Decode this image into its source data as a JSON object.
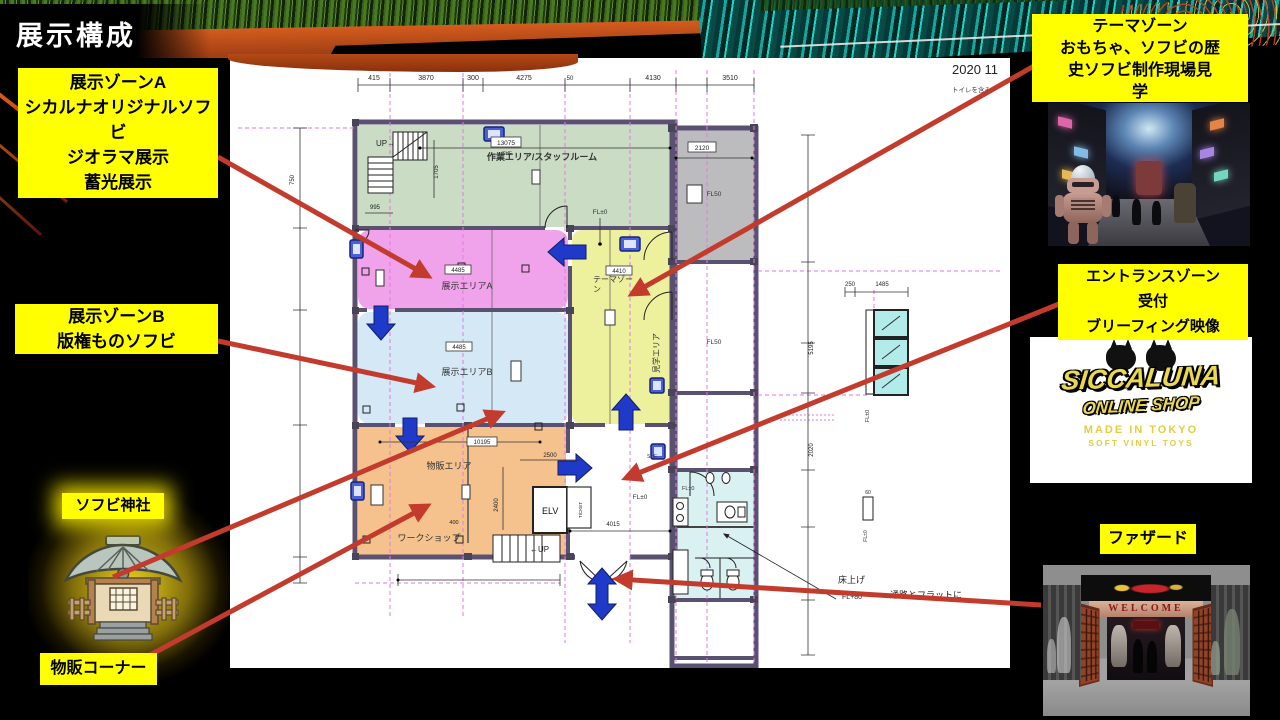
{
  "slide": {
    "title": "展示構成"
  },
  "callouts": {
    "zone_a": {
      "lines": [
        "展示ゾーンA",
        "シカルナオリジナルソフ",
        "ビ",
        "ジオラマ展示",
        "蓄光展示"
      ]
    },
    "zone_b": {
      "lines": [
        "展示ゾーンB",
        "版権ものソフビ"
      ]
    },
    "shrine": {
      "label": "ソフビ神社"
    },
    "sales": {
      "label": "物販コーナー"
    },
    "theme": {
      "lines": [
        "テーマゾーン",
        "おもちゃ、ソフビの歴",
        "史ソフビ制作現場見",
        "学"
      ]
    },
    "entrance": {
      "lines": [
        "エントランスゾーン",
        "受付",
        "ブリーフィング映像"
      ]
    },
    "facade": {
      "label": "ファザード"
    }
  },
  "plan": {
    "date": "2020 11",
    "note": "トイレを含み",
    "rooms": {
      "work_area": "作業エリア/スタッフルーム",
      "exhibit_a": "展示エリアA",
      "exhibit_b": "展示エリアB",
      "theme_l1": "テーマゾー",
      "theme_l2": "ン",
      "tour_area": "見学エリア",
      "shop_area": "物販エリア",
      "workshop": "ワークショップ",
      "elevator": "ELV",
      "ticket": "TICKET",
      "stairs_up_top": "UP→",
      "stairs_up_bottom": "←UP"
    },
    "annotations": {
      "fl_zero": "FL±0",
      "fl_50": "FL50",
      "shf": "SHF",
      "floor_raise": "床上げ",
      "floor_level": "FL+80",
      "floor_flat": "通路とフラットに"
    },
    "dims": {
      "top": [
        "415",
        "3870",
        "300",
        "4275",
        "50",
        "4130",
        "3510"
      ],
      "left_a": "750",
      "right_a": "5195",
      "right_b": "2020",
      "win_a": "250",
      "win_b": "1485",
      "win_c": "60",
      "green_a": "13075",
      "gray_a": "2120",
      "pink_a": "4485",
      "blue_a": "4485",
      "yellow_a": "4410",
      "orange_a": "10195",
      "orange_b": "2500",
      "orange_c": "2400",
      "orange_d": "400",
      "entry_a": "4015",
      "stair_a": "995",
      "stair_b": "1705"
    }
  },
  "logo": {
    "line1": "SICCALUNA",
    "line2": "ONLINE SHOP",
    "line3": "MADE IN TOKYO",
    "line4": "SOFT VINYL TOYS"
  },
  "facade_image": {
    "welcome": "WELCOME"
  },
  "colors": {
    "callout_bg": "#ffff00",
    "arrow_red": "#c23b2c",
    "flow_blue": "#2238c8",
    "room_green": "#cbdcc5",
    "room_pink": "#f0a3ea",
    "room_blue": "#d5e8f5",
    "room_orange": "#f5c28e",
    "room_yellow": "#edf09d",
    "room_gray": "#bcbcbf",
    "toilet_cyan": "#d9f1f0",
    "grid_magenta": "#e07ae0"
  }
}
